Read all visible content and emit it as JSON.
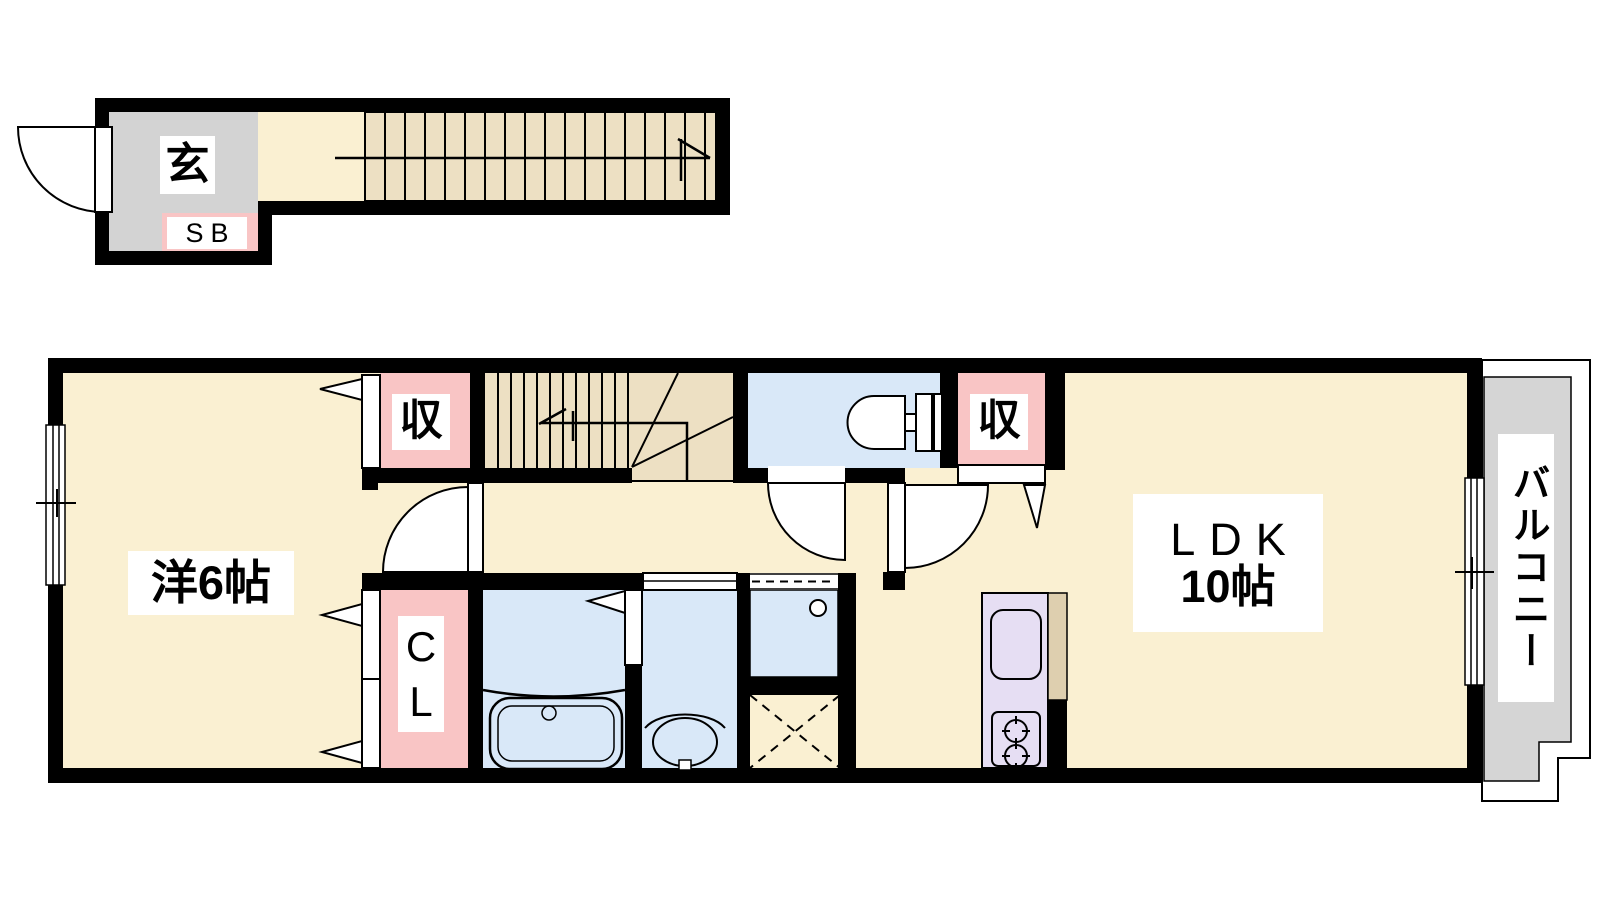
{
  "plan": {
    "upper_section": {
      "entrance_label": "玄",
      "shoebox_label": "SB"
    },
    "main_section": {
      "bedroom_label": "洋6帖",
      "storage_left_label": "収",
      "storage_right_label": "収",
      "closet_label": "CL",
      "ldk_label": "LDK",
      "ldk_size_label": "10帖",
      "balcony_label": "バルコニー"
    },
    "colors": {
      "floor_cream": "#FAF0D2",
      "stair_tan": "#EDE0C3",
      "entrance_gray": "#D3D3D3",
      "balcony_gray": "#D5D5D5",
      "storage_pink": "#F9C5C5",
      "wet_area_blue": "#D9E8F8",
      "kitchen_lavender": "#E6DEF3",
      "counter_tan": "#DECFAF",
      "wall_black": "#000000"
    }
  }
}
